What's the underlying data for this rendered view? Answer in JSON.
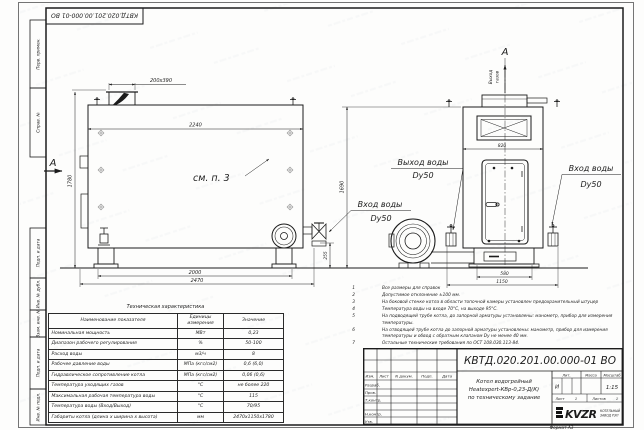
{
  "doc": {
    "stamp_number": "КВТД.020.201.00.000-01 ВО",
    "format_label": "Формат  А3"
  },
  "margins": {
    "top": [
      {
        "label": "Перв. примен."
      },
      {
        "label": "Справ. №"
      }
    ],
    "bottom": [
      {
        "label": "Подп. и дата"
      },
      {
        "label": "Инв. № дубл."
      },
      {
        "label": "Взам. инв. №"
      },
      {
        "label": "Подп. и дата"
      },
      {
        "label": "Инв. № подл."
      }
    ]
  },
  "front_view": {
    "section_marker": "А",
    "note_ref": "см. п. 3",
    "dim_chimney": "200х390",
    "dim_width_top": "2240",
    "dim_height": "1780",
    "dim_valve_height": "255",
    "dim_supports": "2000",
    "dim_length": "2470"
  },
  "side_view": {
    "view_marker": "А",
    "gas_outlet_line1": "Выход",
    "gas_outlet_line2": "газов",
    "dim_width_top": "820",
    "dim_height": "1690",
    "dim_base": "580",
    "dim_width": "1150"
  },
  "callouts": {
    "water_outlet": {
      "line1": "Выход воды",
      "line2": "Dy50"
    },
    "water_inlet_left": {
      "line1": "Вход воды",
      "line2": "Dy50"
    },
    "water_inlet_right": {
      "line1": "Вход воды",
      "line2": "Dy50"
    }
  },
  "notes": [
    {
      "num": "1",
      "text": "Все размеры для справок"
    },
    {
      "num": "2",
      "text": "Допустимое отклонение ±100 мм."
    },
    {
      "num": "3",
      "text": "На боковой стенке котла в области топочной камеры установлен предохранительный штуцер"
    },
    {
      "num": "4",
      "text": "Температура воды на входе 70°С, на выходе 95°С."
    },
    {
      "num": "5",
      "text": "На  подводящей трубе котла, до запорной арматуры установлены: манометр, прибор для измерения температуры."
    },
    {
      "num": "6",
      "text": "На отводящей трубе котла до запорной арматуры установлены: манометр, прибор для измерения температуры и обвод с обратным клапаном Dу не менее 40 мм."
    },
    {
      "num": "7",
      "text": "Остальные технические требования по ОСТ 108.030.113-84."
    }
  ],
  "spec_table": {
    "title": "Техническая характеристика",
    "col_name": "Наименование показателя",
    "col_units": "Единицы измерения",
    "col_value": "Значение",
    "rows": [
      {
        "name": "Номинальная мощность",
        "units": "МВт",
        "value": "0,23"
      },
      {
        "name": "Диапазон рабочего регулирования",
        "units": "%",
        "value": "50-100"
      },
      {
        "name": "Расход воды",
        "units": "м3/ч",
        "value": "8"
      },
      {
        "name": "Рабочее давление воды",
        "units": "МПа (кгс/см2)",
        "value": "0,6 (6,0)"
      },
      {
        "name": "Гидравлическое сопротивление котла",
        "units": "МПа (кгс/см2)",
        "value": "0,06 (0,6)"
      },
      {
        "name": "Температура уходящих газов",
        "units": "°С",
        "value": "не более 220"
      },
      {
        "name": "Максимальная рабочая температура воды",
        "units": "°С",
        "value": "115"
      },
      {
        "name": "Температура воды (Вход/Выход)",
        "units": "°С",
        "value": "70/95"
      },
      {
        "name": "Габариты котла (длина х ширина х высота)",
        "units": "мм",
        "value": "2470х1150х1780"
      }
    ]
  },
  "title_block": {
    "doc_number": "КВТД.020.201.00.000-01  ВО",
    "col_izm": "Изм.",
    "col_list": "Лист",
    "col_doc": "N докум.",
    "col_podp": "Подп.",
    "col_data": "Дата",
    "row_razrab": "Разраб.",
    "row_prov": "Пров.",
    "row_tkontr": "Т.контр.",
    "row_nkontr": "Н.контр.",
    "row_utv": "Утв.",
    "name_line1": "Котел водогрейный",
    "name_line2": "Heatexpert-КВр-0,23-Д(К)",
    "name_line3": "по техническому задание",
    "lit_header": "Лит.",
    "mass_header": "Масса",
    "scale_header": "Масштаб",
    "lit_value": "И",
    "scale_value": "1:15",
    "sheet_label": "Лист",
    "sheet_value": "1",
    "sheets_label": "Листов",
    "sheets_value": "1",
    "logo_text": "KVZR",
    "org_line1": "КОТЕЛЬНЫЙ",
    "org_line2": "ЗАВОД РЭП"
  }
}
